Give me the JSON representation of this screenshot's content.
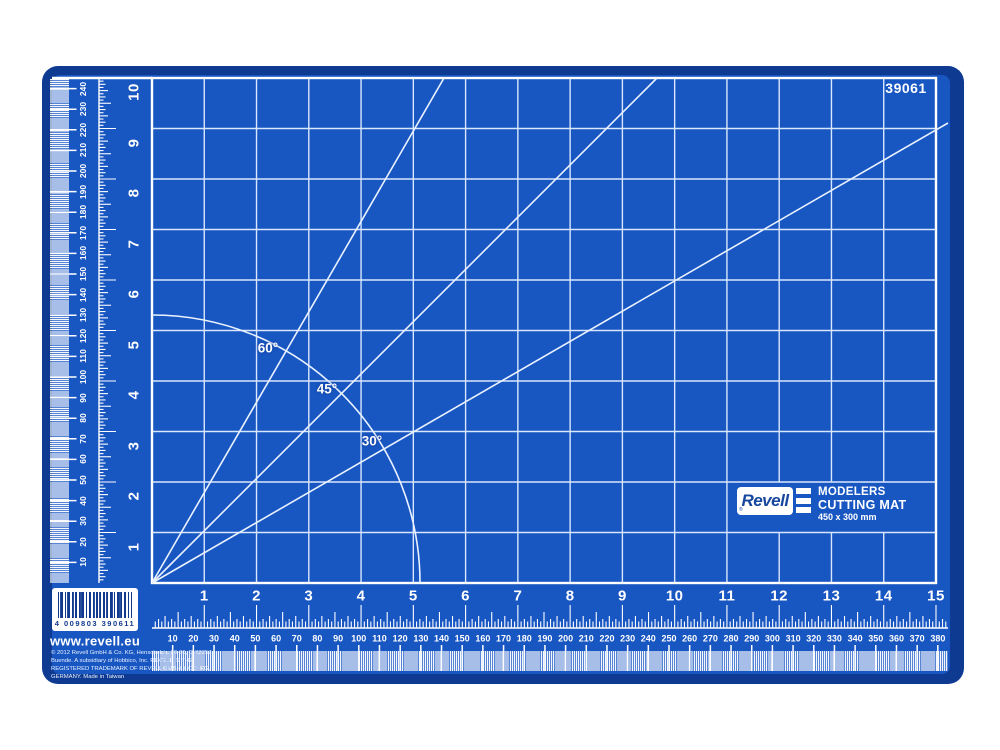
{
  "product": {
    "number": "39061"
  },
  "logo": {
    "brand": "Revell",
    "registered": "®",
    "line1": "MODELERS",
    "line2": "CUTTING MAT",
    "line3": "450 x 300 mm"
  },
  "barcode": {
    "digits": "4 009803 390611"
  },
  "website": "www.revell.eu",
  "legal": {
    "line1": "© 2012 Revell GmbH & Co. KG, Henschelstr. 20-30, D-32257",
    "line2": "Buende. A subsidiary of Hobbico, Inc. REVELL IS THE",
    "line3": "REGISTERED TRADEMARK OF REVELL GMBH & CO. KG,",
    "line4": "GERMANY. Made in Taiwan"
  },
  "angles": {
    "a60": "60°",
    "a45": "45°",
    "a30": "30°"
  },
  "rulers": {
    "bottom_inches": [
      1,
      2,
      3,
      4,
      5,
      6,
      7,
      8,
      9,
      10,
      11,
      12,
      13,
      14,
      15
    ],
    "left_inches": [
      1,
      2,
      3,
      4,
      5,
      6,
      7,
      8,
      9,
      10
    ],
    "bottom_mm": [
      10,
      20,
      30,
      40,
      50,
      60,
      70,
      80,
      90,
      100,
      110,
      120,
      130,
      140,
      150,
      160,
      170,
      180,
      190,
      200,
      210,
      220,
      230,
      240,
      250,
      260,
      270,
      280,
      290,
      300,
      310,
      320,
      330,
      340,
      350,
      360,
      370,
      380
    ],
    "left_mm": [
      10,
      20,
      30,
      40,
      50,
      60,
      70,
      80,
      90,
      100,
      110,
      120,
      130,
      140,
      150,
      160,
      170,
      180,
      190,
      200,
      210,
      220,
      230,
      240
    ]
  },
  "colors": {
    "mat_border": "#0f3a92",
    "mat_surface": "#1856c2",
    "grid_line": "#d9e7fc",
    "marking": "#ffffff",
    "logo_blue": "#17479e"
  }
}
